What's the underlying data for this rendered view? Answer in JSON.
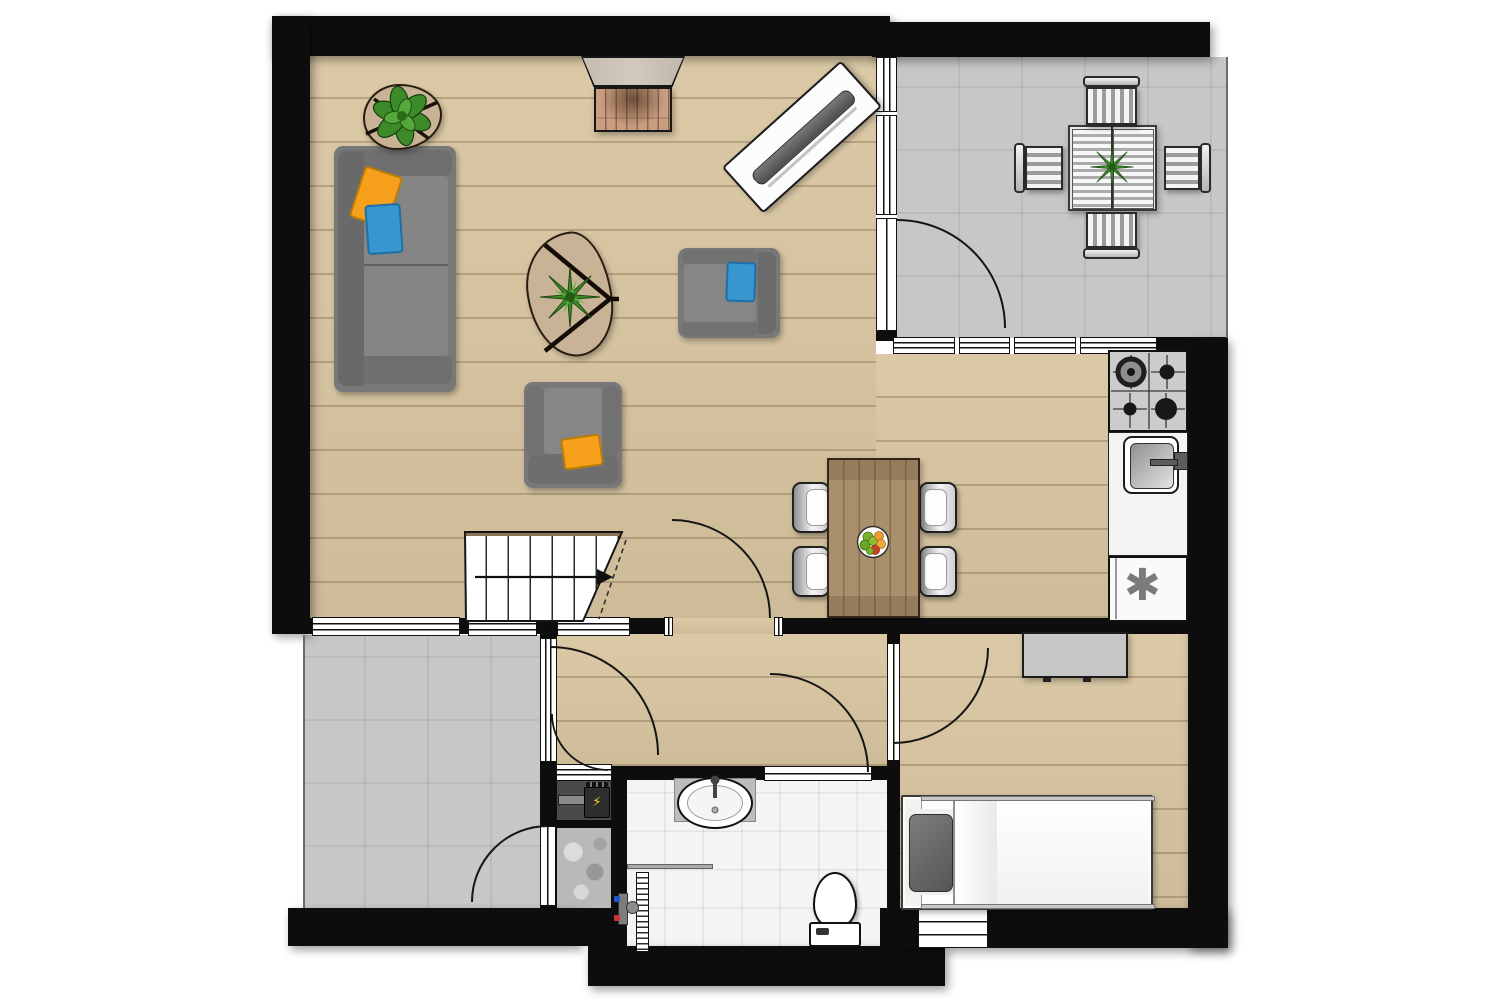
{
  "title": "floor-plan",
  "symbols": {
    "freezer_star": "✱",
    "boiler_bolt": "⚡"
  },
  "palette": {
    "wall": "#0d0d0d",
    "wood_floor": "#d9c6a1",
    "terrace_tile": "#c7c7c7",
    "bathroom_tile": "#f4f4f4",
    "sofa_gray": "#787878",
    "pillow_orange": "#f6a01b",
    "pillow_blue": "#3795cf",
    "plant_green": "#3c8a28",
    "rug_tan": "#c9b396",
    "dining_table_wood": "#a8906c",
    "brick": "#c99d7f",
    "mantle": "#cbc2b6",
    "counter_white": "#f3f3f1",
    "appliance_star_gray": "#7b7b7b"
  },
  "rooms": [
    "living-room",
    "dining-area",
    "kitchen",
    "terrace-top-right",
    "terrace-bottom-left",
    "hallway",
    "bathroom",
    "bedroom",
    "storage-room",
    "utility-niche",
    "staircase"
  ],
  "furniture": [
    "sofa",
    "armchair-blue-pillow",
    "armchair-orange-pillow",
    "coffee-table-with-palm",
    "plant-side-table",
    "fireplace",
    "tv-panel",
    "dining-table",
    "dining-chair",
    "outdoor-table",
    "outdoor-chair",
    "desk",
    "single-bed"
  ],
  "fixtures": [
    "gas-hob",
    "kitchen-sink",
    "freezer",
    "washbasin",
    "toilet",
    "shower-drain",
    "shower-mixer",
    "boiler-unit",
    "fruit-bowl"
  ]
}
